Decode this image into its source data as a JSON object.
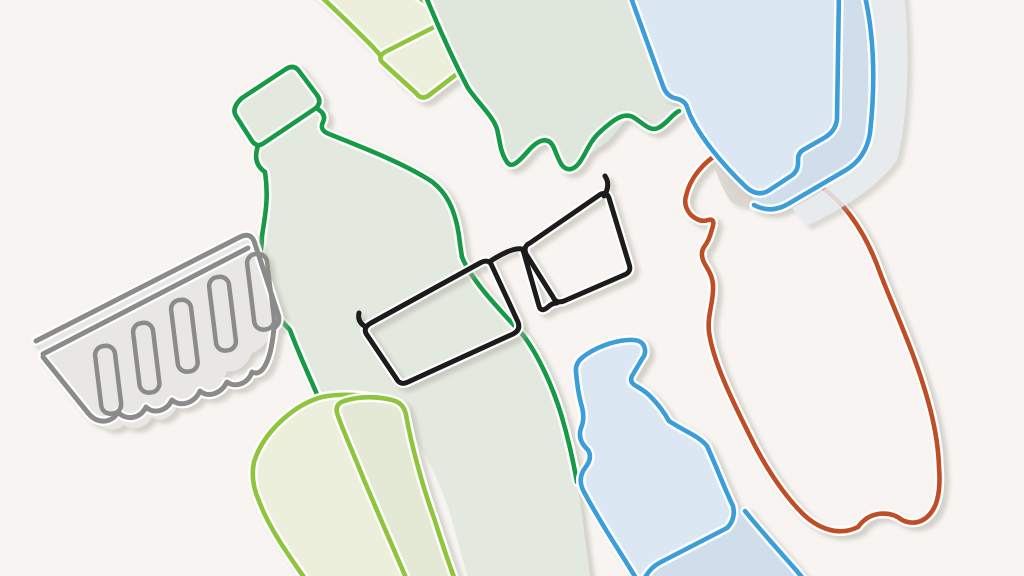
{
  "canvas": {
    "width": 1024,
    "height": 576
  },
  "scene": {
    "style": "continuous-line flat illustration",
    "subject": "plastic packaging items: bottles, jug, tray, soap pump bottle and sunglasses",
    "background": "#f7f4f1"
  },
  "colors": {
    "background": "#f7f4f1",
    "dark_green": "#189a44",
    "light_green": "#8fc43c",
    "blue": "#3b9ed8",
    "orange": "#bf4e26",
    "gray": "#8b8b89",
    "black": "#1a1a1a",
    "casing_white": "#ffffff",
    "shadow": "#a9a79c",
    "sage_fill": "#e4e9e0",
    "sage_fill_dark": "#dfe6dc",
    "lime_fill": "#ecefdb",
    "lime_fill_dark": "#e4e9d5",
    "blue_fill": "#dbe8f4",
    "blue_fill_dark": "#cfdeea",
    "blue_fill_pale": "#e9eff4",
    "peach_fill": "#f4e3d5",
    "tray_fill": "#e8e7e5",
    "lens_fill": "#e3e3e1",
    "overlap_gray": "#d9d5cf",
    "green_tint": "#ccd7d2"
  },
  "objects": [
    {
      "name": "lime-bottle-top"
    },
    {
      "name": "green-bottle-base-top"
    },
    {
      "name": "green-soda-bottle"
    },
    {
      "name": "lime-jug"
    },
    {
      "name": "lime-flask"
    },
    {
      "name": "gray-packaging-tray"
    },
    {
      "name": "sunglasses"
    },
    {
      "name": "orange-soda-bottle"
    },
    {
      "name": "blue-water-bottle"
    },
    {
      "name": "blue-soap-pump-bottle"
    }
  ]
}
